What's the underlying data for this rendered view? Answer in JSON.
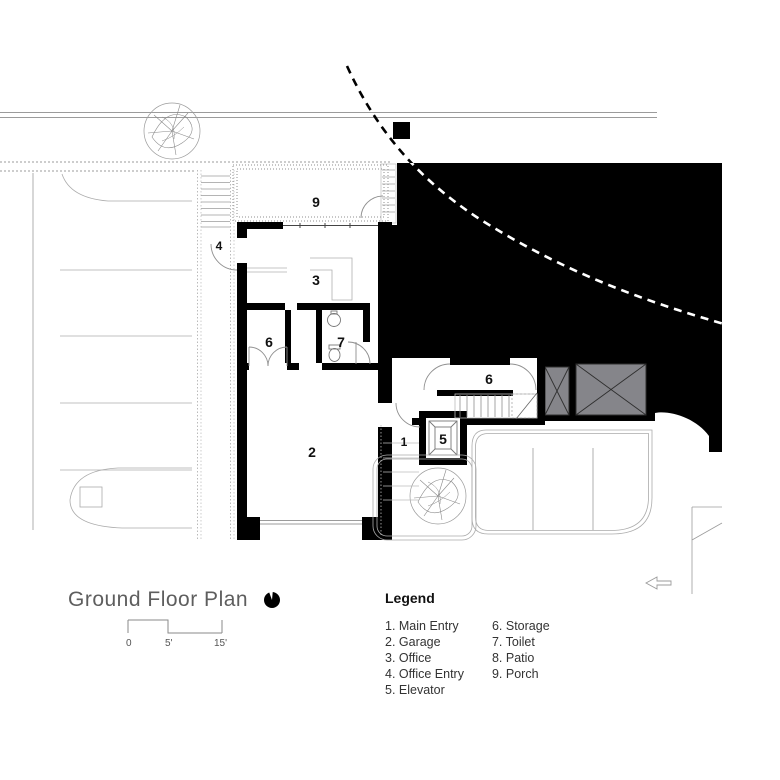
{
  "title_block": {
    "title": "Ground Floor Plan"
  },
  "scale_bar": {
    "t0": "0",
    "t1": "5'",
    "t2": "15'"
  },
  "legend": {
    "heading": "Legend",
    "col1": [
      "1. Main Entry",
      "2. Garage",
      "3. Office",
      "4. Office Entry",
      "5. Elevator"
    ],
    "col2": [
      "6. Storage",
      "7. Toilet",
      "8. Patio",
      "9. Porch"
    ]
  },
  "plan": {
    "labels": {
      "porch": "9",
      "office_entry": "4",
      "office": "3",
      "storage_left": "6",
      "toilet": "7",
      "garage": "2",
      "main_entry": "1",
      "elevator": "5",
      "storage_right": "6"
    },
    "colors": {
      "wall": "#000000",
      "shaft_fill": "#85858a",
      "site_line": "#9b9b9b"
    }
  }
}
